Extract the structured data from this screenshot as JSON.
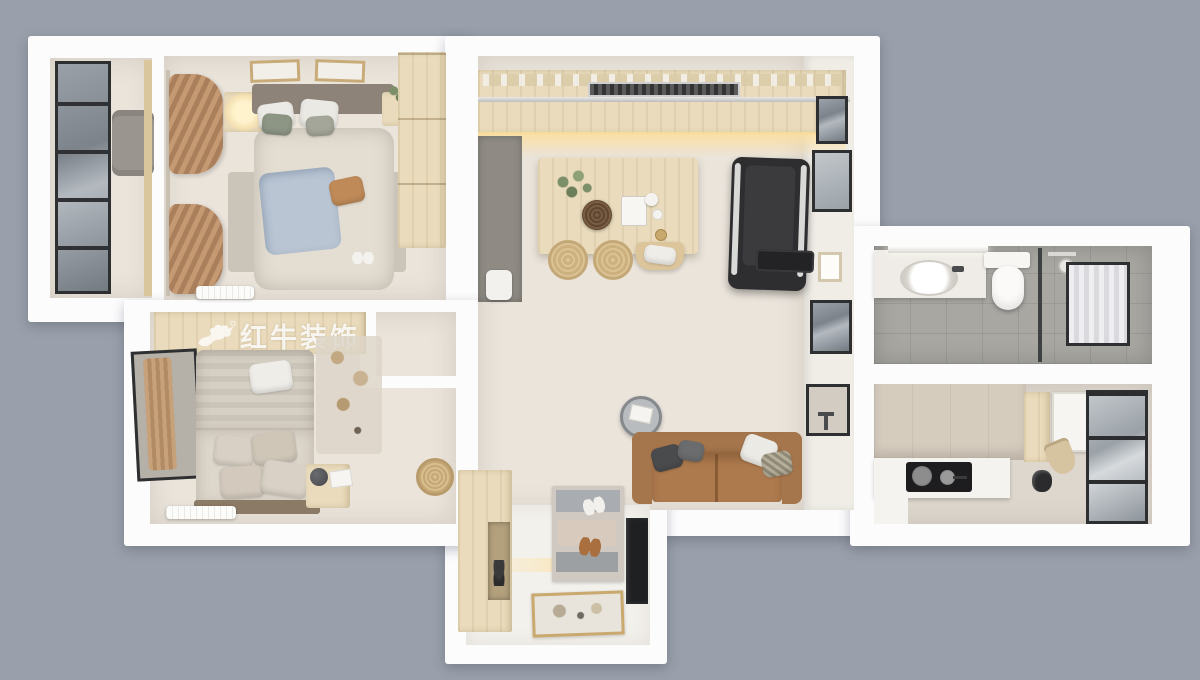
{
  "watermark": {
    "logo": "bull-logo",
    "name": "红牛装饰",
    "subtitle": "HONG NIU DECORATION"
  },
  "palette": {
    "bg": "#9aa0ab",
    "wall": "#fcfcfd",
    "floor-warm": "#eae4db",
    "floor-entry": "#f3f1ec",
    "wood": "#e9dbbc",
    "wood-dark": "#d9c69c",
    "cabinet-gray": "#8f8b84",
    "frame-dark": "#2e2f31",
    "tile-gray": "#a8a7a2",
    "tile-beige": "#d6ccbe",
    "sofa-brown": "#ad7a4e",
    "blanket-blue": "#b9c5d3",
    "pillow-green": "#8d9585",
    "pillow-caramel": "#bf8a58",
    "treadmill-dark": "#2e2e30",
    "glow-warm": "#f7e7bf"
  },
  "scene": {
    "type": "3d-top-down-apartment-floor-plan-render",
    "rooms": [
      {
        "name": "balcony",
        "items": [
          "glass-window-wall",
          "gray-lounge-chair"
        ]
      },
      {
        "name": "master-bedroom",
        "items": [
          "double-bed",
          "blue-blanket",
          "wall-art-frames",
          "nightstand-lamp",
          "plant",
          "wardrobe",
          "rug",
          "curtains",
          "air-conditioner",
          "slippers"
        ]
      },
      {
        "name": "kitchen-dining",
        "items": [
          "upper-cabinet-run",
          "range-hood",
          "tall-gray-cabinet",
          "trash-bin",
          "dining-table",
          "plant-bowl",
          "serving-tray",
          "wicker-stools",
          "bench-chair"
        ]
      },
      {
        "name": "living-area",
        "items": [
          "treadmill",
          "wall-frames",
          "pass-through-niche",
          "round-side-table",
          "leather-sofa",
          "throw-pillows"
        ]
      },
      {
        "name": "entry",
        "items": [
          "shoe-cabinet",
          "terrazzo-rug",
          "shoes",
          "dark-mirror-panel",
          "doormat"
        ]
      },
      {
        "name": "bathroom",
        "items": [
          "vanity-sink",
          "mirror-light",
          "wall-hung-toilet",
          "glass-partition",
          "shower-head",
          "pendant-ball-lamp",
          "curtained-window"
        ]
      },
      {
        "name": "kitchen-rear",
        "items": [
          "tiled-wall",
          "wood-cabinet",
          "sink",
          "hanging-bag",
          "l-counter",
          "gas-cooktop",
          "pans",
          "kettle",
          "black-framed-glass-door"
        ]
      },
      {
        "name": "second-bedroom",
        "items": [
          "wardrobe-top",
          "bed",
          "striped-duvet",
          "pillows",
          "window-with-curtain",
          "rug",
          "nightstand-ball-lamp",
          "rattan-pouf",
          "air-conditioner"
        ]
      }
    ]
  }
}
